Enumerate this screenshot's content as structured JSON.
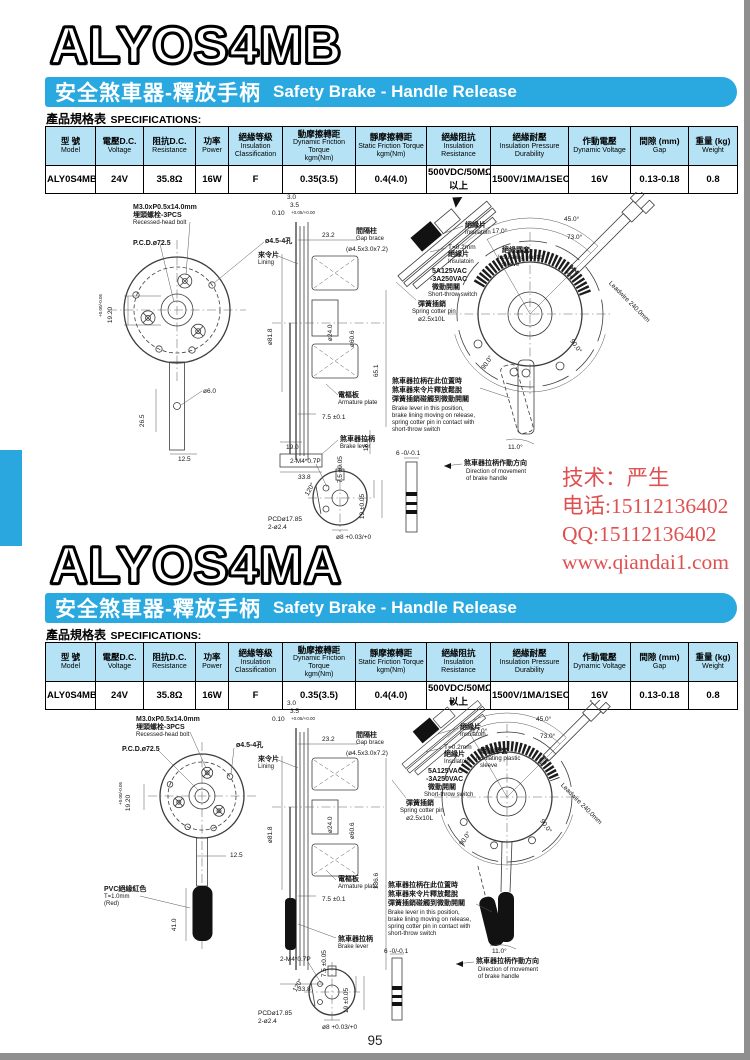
{
  "colors": {
    "banner": "#29a9e0",
    "table_header_bg": "#b5e3f5",
    "contact_red": "#df5050",
    "side_tab": "#2aa7de"
  },
  "page_number": "95",
  "contact": {
    "line1": "技术：严生",
    "line2": "电话:15112136402",
    "line3": "QQ:15112136402",
    "line4": "www.qiandai1.com"
  },
  "spec_label": {
    "zh": "產品規格表",
    "en": "SPECIFICATIONS:"
  },
  "spec_table": {
    "headers": [
      {
        "zh": "型 號",
        "en": "Model"
      },
      {
        "zh": "電壓D.C.",
        "en": "Voltage"
      },
      {
        "zh": "阻抗D.C.",
        "en": "Resistance"
      },
      {
        "zh": "功率",
        "en": "Power"
      },
      {
        "zh": "絕緣等級",
        "en": "Insulation Classification"
      },
      {
        "zh": "動摩擦轉距",
        "en": "Dynamic Friction Torque",
        "sub": "kgm(Nm)"
      },
      {
        "zh": "靜摩擦轉距",
        "en": "Static Friction Torque",
        "sub": "kgm(Nm)"
      },
      {
        "zh": "絕緣阻抗",
        "en": "Insulation Resistance"
      },
      {
        "zh": "絕緣耐壓",
        "en": "Insulation Pressure Durability"
      },
      {
        "zh": "作動電壓",
        "en": "Dynamic Voltage"
      },
      {
        "zh": "間隙 (mm)",
        "en": "Gap"
      },
      {
        "zh": "重量 (kg)",
        "en": "Weight"
      }
    ],
    "row": [
      "ALY0S4MB",
      "24V",
      "35.8Ω",
      "16W",
      "F",
      "0.35(3.5)",
      "0.4(4.0)",
      "500VDC/50MΩ以上",
      "1500V/1MA/1SEC",
      "16V",
      "0.13-0.18",
      "0.8"
    ]
  },
  "sections": [
    {
      "title": "ALYOS4MB",
      "banner_zh": "安全煞車器-釋放手柄",
      "banner_en": "Safety Brake - Handle Release",
      "d": {
        "bolt1": "M3.0xP0.5x14.0mm",
        "bolt2": "埋頭螺栓-3PCS",
        "bolt3": "Recessed-head bolt",
        "pcd": "P.C.D.ø72.5",
        "holes": "ø4.5-4孔",
        "d1920": "19.20",
        "tol1920": "+0.00/-0.05",
        "d60": "ø6.0",
        "d265": "26.5",
        "d125": "12.5",
        "lining_zh": "來令片",
        "lining_en": "Lining",
        "d30": "3.0",
        "d35": "3.5",
        "d010": "0.10",
        "tol010": "+0.05/+0.00",
        "d232": "23.2",
        "gap_zh": "間隔柱",
        "gap_en": "Gap brace",
        "gap_size": "(ø4.5x3.0x7.2)",
        "d818": "ø81.8",
        "d240": "ø24.0",
        "d606": "ø60.6",
        "dlen": "65.1",
        "arm_zh": "電樞板",
        "arm_en": "Armature plate",
        "d75": "7.5 ±0.1",
        "d166": "16.6",
        "d190": "19.0",
        "d338": "33.8",
        "lever_zh": "煞車器拉柄",
        "lever_en": "Brake lever",
        "ins_zh": "絕緣片",
        "ins_en": "Insulatoin",
        "t02a": "T=0.2mm",
        "t02b": "絕緣片",
        "t02c": "Insulatoin",
        "sw1": "5A125VAC",
        "sw2": "-3A250VAC",
        "sw3": "微動開關",
        "sw4": "Short-throw switch",
        "cot1": "彈簧插銷",
        "cot2": "Spring cotter pin",
        "cot3": "ø2.5x10L",
        "slv1": "絕緣膠套",
        "slv2": "Insulating plastic",
        "slv3": "sleeve",
        "a17": "17.0°",
        "a45": "45.0°",
        "a73": "73.0°",
        "a90a": "90.0°",
        "a90b": "90.0°",
        "a11": "11.0°",
        "lw1": "Leadwire",
        "lw2": "240.0mm",
        "nz1": "煞車器拉柄在此位置時",
        "nz2": "煞車器來令片釋放鬆脫",
        "nz3": "彈簧插銷碰觸到微動開關",
        "ne1": "Brake lever in this position,",
        "ne2": "brake lining moving on release,",
        "ne3": "spring cotter pin in contact with",
        "ne4": "short-throw switch",
        "dir_zh": "煞車器拉柄作動方向",
        "dir_e1": "Direction of movement",
        "dir_e2": "of brake handle",
        "hm4": "2-M4*0.7P",
        "h120": "120°",
        "hpcd1": "PCDø17.85",
        "hpcd2": "2-ø2.4",
        "h75": "7.5 ±0.05",
        "h19": "19 ±0.05",
        "hd8": "ø8 +0.03/+0",
        "h6": "6 -0/-0.1"
      }
    },
    {
      "title": "ALYOS4MA",
      "banner_zh": "安全煞車器-釋放手柄",
      "banner_en": "Safety Brake - Handle Release",
      "d": {
        "bolt1": "M3.0xP0.5x14.0mm",
        "bolt2": "埋頭螺栓-3PCS",
        "bolt3": "Recessed-head bolt",
        "pcd": "P.C.D.ø72.5",
        "holes": "ø4.5-4孔",
        "d1920": "19.20",
        "tol1920": "+0.00/-0.05",
        "d125": "12.5",
        "pvc1": "PVC絕緣紅色",
        "pvc2": "T=1.0mm",
        "pvc3": "(Red)",
        "d410": "41.0",
        "lining_zh": "來令片",
        "lining_en": "Lining",
        "d30": "3.0",
        "d35": "3.5",
        "d010": "0.10",
        "tol010": "+0.05/+0.00",
        "d232": "23.2",
        "gap_zh": "間隔柱",
        "gap_en": "Gap brace",
        "gap_size": "(ø4.5x3.0x7.2)",
        "d818": "ø81.8",
        "d240": "ø24.0",
        "d606": "ø60.6",
        "dlen": "136.6",
        "arm_zh": "電樞板",
        "arm_en": "Armature plate",
        "d75": "7.5 ±0.1",
        "d338": "33.8",
        "lever_zh": "煞車器拉柄",
        "lever_en": "Brake lever",
        "ins_zh": "絕緣片",
        "ins_en": "Insulatoin",
        "t02a": "T=0.2mm",
        "t02b": "絕緣片",
        "t02c": "Insulatoin",
        "sw1": "5A125VAC",
        "sw2": "-3A250VAC",
        "sw3": "微動開關",
        "sw4": "Short-throw switch",
        "cot1": "彈簧插銷",
        "cot2": "Spring cotter pin",
        "cot3": "ø2.5x10L",
        "slv1": "絕緣膠套",
        "slv2": "Insulating plastic",
        "slv3": "sleeve",
        "a17": "17.0°",
        "a45": "45.0°",
        "a73": "73.0°",
        "a90a": "90.0°",
        "a90b": "90.0°",
        "a11": "11.0°",
        "lw1": "Leadwire",
        "lw2": "240.0mm",
        "nz1": "煞車器拉柄在此位置時",
        "nz2": "煞車器來令片釋放鬆脫",
        "nz3": "彈簧插銷碰觸到微動開關",
        "ne1": "Brake lever in this position,",
        "ne2": "brake lining moving on release,",
        "ne3": "spring cotter pin in contact with",
        "ne4": "short-throw switch",
        "dir_zh": "煞車器拉柄作動方向",
        "dir_e1": "Direction of movement",
        "dir_e2": "of brake handle",
        "hm4": "2-M4*0.7P",
        "h120": "120°",
        "hpcd1": "PCDø17.85",
        "hpcd2": "2-ø2.4",
        "h75": "7.5 ±0.05",
        "h19": "19 ±0.05",
        "hd8": "ø8 +0.03/+0",
        "h6": "6 -0/-0.1"
      }
    }
  ]
}
